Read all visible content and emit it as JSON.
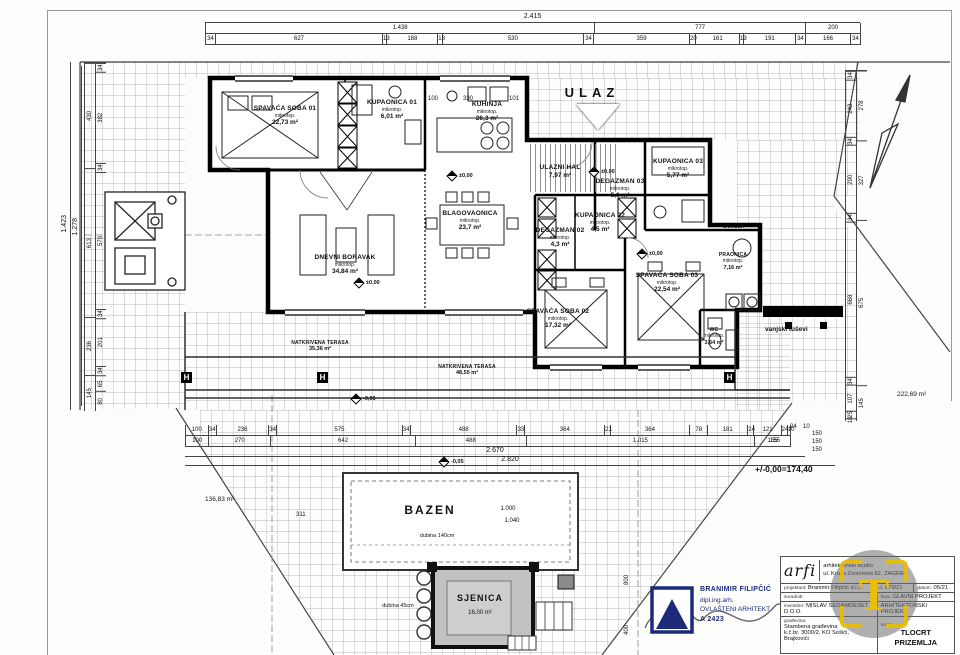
{
  "sheet": {
    "drawing_title": "TLOCRT PRIZEMLJA",
    "level_note": "+/-0,00=174,40"
  },
  "labels": {
    "ulaz": "ULAZ",
    "bazen": "BAZEN",
    "pool_dim1": "1.000",
    "pool_dim2": "1.040",
    "pool_depth1": "dubina 140cm",
    "pool_depth2": "dubina 45cm",
    "sjenica": "SJENICA",
    "sjenica_area": "16,00 m²",
    "outdoor_showers": "vanjski tuševi",
    "plot_area_left": "136,83 m²",
    "plot_area_right": "222,69 m²",
    "h_marker": "H",
    "pm_zero": "±0,00",
    "minus_005": "-0,05"
  },
  "rooms": [
    {
      "name": "SPAVAĆA SOBA 01",
      "sub": "mikrotop.",
      "area": "22,73 m²"
    },
    {
      "name": "KUPAONICA 01",
      "sub": "mikrotop.",
      "area": "6,01 m²"
    },
    {
      "name": "KUHINJA",
      "sub": "mikrotop.",
      "area": "26,3 m²"
    },
    {
      "name": "BLAGOVAONICA",
      "sub": "mikrotop.",
      "area": "23,7 m²"
    },
    {
      "name": "DNEVNI BORAVAK",
      "sub": "mikrotop.",
      "area": "34,84 m²"
    },
    {
      "name": "ULAZNI HAL",
      "sub": "",
      "area": "7,97 m²"
    },
    {
      "name": "DEGAZMAN 03",
      "sub": "mikrotop.",
      "area": "5,0 m²"
    },
    {
      "name": "KUPAONICA 03",
      "sub": "mikrotop.",
      "area": "5,77 m²"
    },
    {
      "name": "DEGAZMAN 02",
      "sub": "mikrotop.",
      "area": "4,3 m²"
    },
    {
      "name": "KUPAONICA 02",
      "sub": "mikrotop.",
      "area": "4,5 m²"
    },
    {
      "name": "SPAVAĆA SOBA 03",
      "sub": "mikrotop.",
      "area": "22,54 m²"
    },
    {
      "name": "SPAVAĆA SOBA 02",
      "sub": "mikrotop.",
      "area": "17,32 m²"
    },
    {
      "name": "BOJLER",
      "sub": "",
      "area": ""
    },
    {
      "name": "PRAONICA",
      "sub": "mikrotop.",
      "area": "7,16 m²"
    },
    {
      "name": "WC",
      "sub": "mikrotop.",
      "area": "3,64 m²"
    },
    {
      "name": "NATKRIVENA TERASA",
      "sub": "",
      "area": "35,36 m²"
    },
    {
      "name": "NATKRIVENA TERASA",
      "sub": "",
      "area": "48,55 m²"
    }
  ],
  "dims": {
    "top": {
      "overall": "2.415",
      "spans": [
        "1.438",
        "777",
        "200"
      ],
      "segments": [
        "34",
        "627",
        "13",
        "188",
        "13",
        "530",
        "34",
        "359",
        "20",
        "161",
        "13",
        "191",
        "34",
        "166",
        "34"
      ]
    },
    "left": {
      "overall": "1.423",
      "inner": "1.278",
      "spans": [
        "430",
        "613",
        "236",
        "145"
      ],
      "segments": [
        "34",
        "382",
        "34",
        "579",
        "34",
        "201",
        "34",
        "65",
        "80"
      ]
    },
    "right": {
      "spans": [
        "278",
        "327",
        "675",
        "145"
      ],
      "segments": [
        "34",
        "242",
        "34",
        "290",
        "34",
        "668",
        "34",
        "107",
        "25",
        "10"
      ]
    },
    "bottom": {
      "overall1": "2.670",
      "overall2": "2.820",
      "row1": [
        "100",
        "34",
        "236",
        "34",
        "575",
        "34",
        "488",
        "33",
        "364",
        "21",
        "364",
        "78",
        "181",
        "24",
        "121",
        "24",
        "10"
      ],
      "row2": [
        "100",
        "270",
        "642",
        "488",
        "1.015",
        "155"
      ],
      "right_pair_a": "24",
      "right_pair_b": "10",
      "right_stack": [
        "150",
        "150",
        "150"
      ],
      "extra": "155"
    },
    "misc": {
      "k100": "100",
      "k330": "330",
      "k101": "101",
      "n311": "311",
      "n800": "800",
      "n400": "400"
    }
  },
  "titleblock": {
    "logo": "arfi",
    "studio_line1": "arhitektonski studio",
    "studio_line2": "ul. Kralja Zvonimira 62, ZAGREB",
    "projektant_label": "projektant:",
    "projektant": "Branimir Filipčić d.i.a.",
    "td_label": "t.d.",
    "td": "879/21",
    "datum_label": "datum:",
    "datum": "05/21",
    "suradnik_label": "suradnik:",
    "suradnik": "",
    "faza_label": "faza:",
    "faza1": "GLAVNI PROJEKT",
    "faza2": "ARHITEKTONSKI PROJEKT",
    "investitor_label": "investitor:",
    "investitor": "MISLAV SEDAMDESET D.O.O.",
    "gradjevina_label": "građevina:",
    "gradjevina1": "Stambena građevina",
    "gradjevina2": "k.č.br. 3000/2, KO Sošići, Brajkovići",
    "nacrt_label": "nacrt",
    "nacrt1": "TLOCRT",
    "nacrt2": "PRIZEMLJA"
  },
  "stamp": {
    "name": "BRANIMIR FILIPČIĆ",
    "title": "dipl.ing.arh.",
    "license": "OVLAŠTENI ARHITEKT",
    "number": "A 2423"
  },
  "watermark": {
    "letter": "T"
  },
  "colors": {
    "wall": "#000000",
    "stamp_blue": "#1c2a7a",
    "watermark_yellow": "#eebe00",
    "gazebo_fill": "#c2c2c2"
  }
}
